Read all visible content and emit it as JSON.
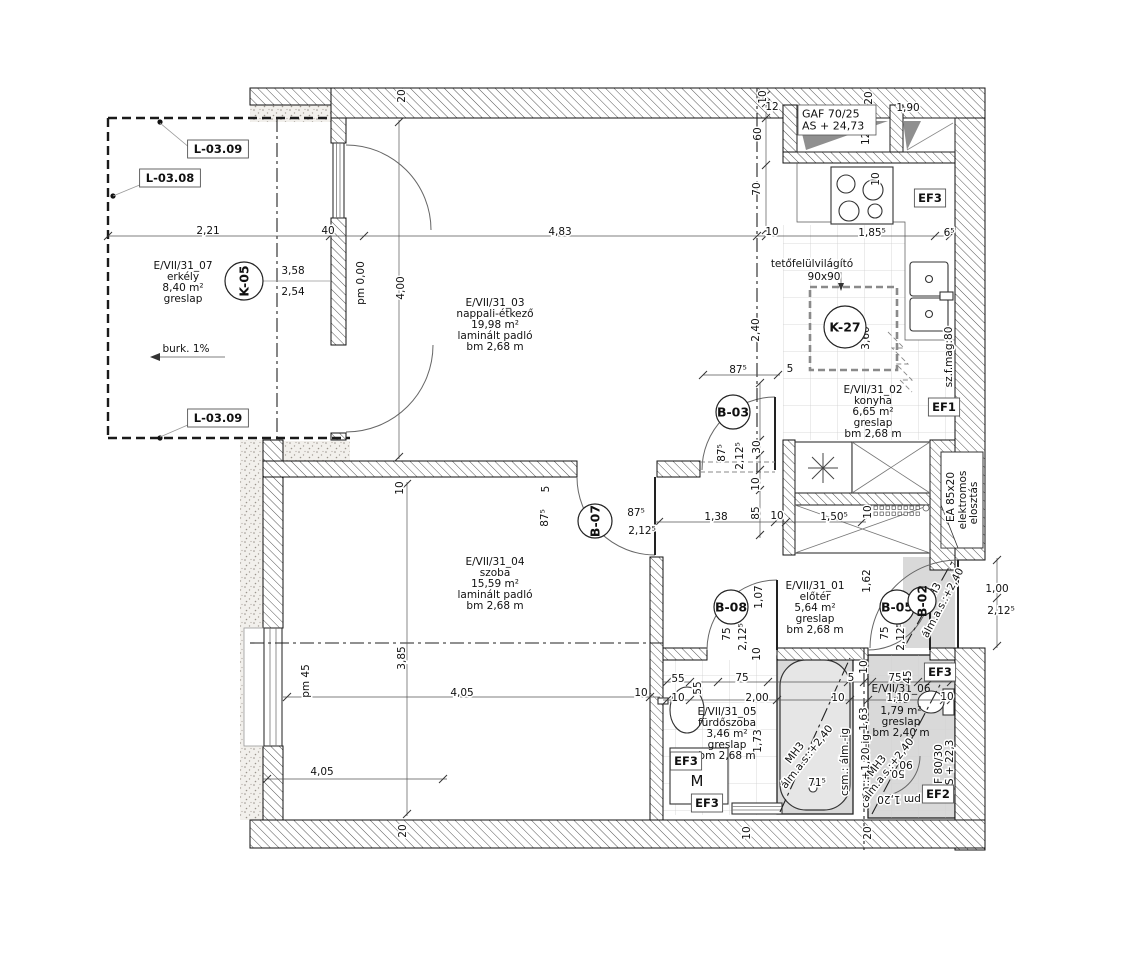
{
  "colors": {
    "wall_line": "#111111",
    "hatch_line": "#555555",
    "lowered_ceiling_zone": "#d9d9d9",
    "tile_grid": "#cccccc",
    "paper": "#ffffff"
  },
  "rooms": [
    {
      "id": "erkely",
      "lines": [
        "E/VII/31_07",
        "erkély",
        "8,40 m²",
        "greslap"
      ],
      "x": 183,
      "y": 266
    },
    {
      "id": "nappali",
      "lines": [
        "E/VII/31_03",
        "nappali-étkező",
        "19,98 m²",
        "laminált padló",
        "bm 2,68 m"
      ],
      "x": 495,
      "y": 303
    },
    {
      "id": "konyha",
      "lines": [
        "E/VII/31_02",
        "konyha",
        "6,65 m²",
        "greslap",
        "bm 2,68 m"
      ],
      "x": 873,
      "y": 390
    },
    {
      "id": "szoba",
      "lines": [
        "E/VII/31_04",
        "szoba",
        "15,59 m²",
        "laminált padló",
        "bm 2,68 m"
      ],
      "x": 495,
      "y": 562
    },
    {
      "id": "eloter",
      "lines": [
        "E/VII/31_01",
        "előtér",
        "5,64 m²",
        "greslap",
        "bm 2,68 m"
      ],
      "x": 815,
      "y": 586
    },
    {
      "id": "furdoszoba",
      "lines": [
        "E/VII/31_05",
        "fürdőszoba",
        "3,46 m²",
        "greslap",
        "bm 2,68 m"
      ],
      "x": 727,
      "y": 712
    },
    {
      "id": "wc",
      "lines": [
        "E/VII/31_06",
        "wc",
        "1,79 m²",
        "greslap",
        "bm 2,40 m"
      ],
      "x": 901,
      "y": 689
    }
  ],
  "tags": [
    {
      "t": "K-05",
      "x": 244,
      "y": 281,
      "r": 19,
      "rot": -90
    },
    {
      "t": "K-27",
      "x": 845,
      "y": 327,
      "r": 21,
      "rot": 0
    },
    {
      "t": "B-03",
      "x": 733,
      "y": 412,
      "r": 17,
      "rot": 0
    },
    {
      "t": "B-07",
      "x": 595,
      "y": 521,
      "r": 17,
      "rot": -90
    },
    {
      "t": "B-08",
      "x": 731,
      "y": 607,
      "r": 17,
      "rot": 0
    },
    {
      "t": "B-05",
      "x": 897,
      "y": 607,
      "r": 17,
      "rot": 0
    },
    {
      "t": "B-02",
      "x": 922,
      "y": 601,
      "r": 14,
      "rot": -90
    }
  ],
  "ref_boxes": [
    {
      "t": "L-03.09",
      "x": 218,
      "y": 149
    },
    {
      "t": "L-03.08",
      "x": 170,
      "y": 178
    },
    {
      "t": "L-03.09",
      "x": 218,
      "y": 418
    },
    {
      "t": "EF3",
      "x": 930,
      "y": 198
    },
    {
      "t": "EF1",
      "x": 944,
      "y": 407
    },
    {
      "t": "EF3",
      "x": 940,
      "y": 672
    },
    {
      "t": "EF3",
      "x": 686,
      "y": 761
    },
    {
      "t": "EF3",
      "x": 707,
      "y": 803
    },
    {
      "t": "EF2",
      "x": 938,
      "y": 794
    }
  ],
  "info_box": {
    "lines": [
      "GAF  70/25",
      "AS + 24,73"
    ],
    "x": 798,
    "y": 105
  },
  "dims": [
    {
      "t": "2,21",
      "x": 208,
      "y": 231
    },
    {
      "t": "40",
      "x": 328,
      "y": 231
    },
    {
      "t": "4,83",
      "x": 560,
      "y": 232
    },
    {
      "t": "10",
      "x": 772,
      "y": 232
    },
    {
      "t": "1,85⁵",
      "x": 872,
      "y": 233
    },
    {
      "t": "6⁵",
      "x": 949,
      "y": 233
    },
    {
      "t": "3,58",
      "x": 293,
      "y": 271
    },
    {
      "t": "2,54",
      "x": 293,
      "y": 292
    },
    {
      "t": "4,00",
      "x": 401,
      "y": 288,
      "r": -90
    },
    {
      "t": "20",
      "x": 402,
      "y": 96,
      "r": -90
    },
    {
      "t": "10",
      "x": 763,
      "y": 97,
      "r": -90
    },
    {
      "t": "12",
      "x": 772,
      "y": 107
    },
    {
      "t": "60",
      "x": 758,
      "y": 134,
      "r": -90
    },
    {
      "t": "70",
      "x": 757,
      "y": 189,
      "r": -90
    },
    {
      "t": "20",
      "x": 869,
      "y": 98,
      "r": -90
    },
    {
      "t": "1,90",
      "x": 908,
      "y": 108
    },
    {
      "t": "10",
      "x": 876,
      "y": 179,
      "r": -90
    },
    {
      "t": "2,40",
      "x": 756,
      "y": 330,
      "r": -90
    },
    {
      "t": "3,60",
      "x": 866,
      "y": 338,
      "r": -90
    },
    {
      "t": "87⁵",
      "x": 738,
      "y": 370
    },
    {
      "t": "5",
      "x": 790,
      "y": 369
    },
    {
      "t": "87⁵",
      "x": 722,
      "y": 453,
      "r": -90
    },
    {
      "t": "2,12⁵",
      "x": 740,
      "y": 456,
      "r": -90
    },
    {
      "t": "30",
      "x": 757,
      "y": 447,
      "r": -90
    },
    {
      "t": "10",
      "x": 756,
      "y": 484,
      "r": -90
    },
    {
      "t": "85",
      "x": 756,
      "y": 513,
      "r": -90
    },
    {
      "t": "10",
      "x": 777,
      "y": 516
    },
    {
      "t": "1,38",
      "x": 716,
      "y": 517
    },
    {
      "t": "1,50⁵",
      "x": 834,
      "y": 517
    },
    {
      "t": "10",
      "x": 868,
      "y": 512,
      "r": -90
    },
    {
      "t": "87⁵",
      "x": 636,
      "y": 513
    },
    {
      "t": "2,12⁵",
      "x": 642,
      "y": 531
    },
    {
      "t": "87⁵",
      "x": 545,
      "y": 518,
      "r": -90
    },
    {
      "t": "5",
      "x": 546,
      "y": 489,
      "r": -90
    },
    {
      "t": "10",
      "x": 400,
      "y": 488,
      "r": -90
    },
    {
      "t": "3,85",
      "x": 402,
      "y": 658,
      "r": -90
    },
    {
      "t": "4,05",
      "x": 462,
      "y": 693
    },
    {
      "t": "10",
      "x": 641,
      "y": 693
    },
    {
      "t": "4,05",
      "x": 322,
      "y": 772
    },
    {
      "t": "20",
      "x": 403,
      "y": 831,
      "r": -90
    },
    {
      "t": "1,07",
      "x": 759,
      "y": 597,
      "r": -90
    },
    {
      "t": "75",
      "x": 727,
      "y": 634,
      "r": -90
    },
    {
      "t": "2,12⁵",
      "x": 743,
      "y": 637,
      "r": -90
    },
    {
      "t": "10",
      "x": 757,
      "y": 654,
      "r": -90
    },
    {
      "t": "1,62",
      "x": 867,
      "y": 581,
      "r": -90
    },
    {
      "t": "75",
      "x": 885,
      "y": 633,
      "r": -90
    },
    {
      "t": "2,12⁵",
      "x": 901,
      "y": 637,
      "r": -90
    },
    {
      "t": "1,00",
      "x": 997,
      "y": 589
    },
    {
      "t": "2,12⁵",
      "x": 1001,
      "y": 611
    },
    {
      "t": "55",
      "x": 678,
      "y": 679
    },
    {
      "t": "55",
      "x": 698,
      "y": 688,
      "r": -90
    },
    {
      "t": "75",
      "x": 742,
      "y": 678
    },
    {
      "t": "5",
      "x": 851,
      "y": 678
    },
    {
      "t": "10",
      "x": 678,
      "y": 698
    },
    {
      "t": "2,00",
      "x": 757,
      "y": 698
    },
    {
      "t": "10",
      "x": 838,
      "y": 698
    },
    {
      "t": "1,73",
      "x": 758,
      "y": 741,
      "r": -90
    },
    {
      "t": "71⁵",
      "x": 817,
      "y": 783
    },
    {
      "t": "1,63",
      "x": 864,
      "y": 719,
      "r": -90
    },
    {
      "t": "10",
      "x": 864,
      "y": 667,
      "r": -90
    },
    {
      "t": "75",
      "x": 895,
      "y": 678
    },
    {
      "t": "45",
      "x": 908,
      "y": 677,
      "r": -90
    },
    {
      "t": "1,10",
      "x": 898,
      "y": 698
    },
    {
      "t": "10",
      "x": 947,
      "y": 697
    },
    {
      "t": "10",
      "x": 747,
      "y": 833,
      "r": -90
    },
    {
      "t": "20",
      "x": 868,
      "y": 833,
      "r": -90
    },
    {
      "t": "50",
      "x": 898,
      "y": 773,
      "r": 180
    },
    {
      "t": "90",
      "x": 906,
      "y": 764,
      "r": 180
    },
    {
      "t": "12  48",
      "x": 866,
      "y": 130,
      "r": -90
    }
  ],
  "notes": [
    {
      "t": "tetőfelülvilágító",
      "x": 812,
      "y": 264
    },
    {
      "t": "90x90",
      "x": 824,
      "y": 277
    },
    {
      "t": "burk. 1%",
      "x": 186,
      "y": 349
    },
    {
      "t": "pm 0,00",
      "x": 361,
      "y": 283,
      "r": -90
    },
    {
      "t": "pm 45",
      "x": 306,
      "y": 681,
      "r": -90
    },
    {
      "t": "sz.f.mag:80",
      "x": 949,
      "y": 357,
      "r": -90
    },
    {
      "t": "EA 85x20",
      "x": 951,
      "y": 497,
      "r": -90
    },
    {
      "t": "elektromos",
      "x": 963,
      "y": 500,
      "r": -90
    },
    {
      "t": "elosztás",
      "x": 974,
      "y": 503,
      "r": -90
    },
    {
      "t": "csm.: álm.-ig",
      "x": 845,
      "y": 762,
      "r": -90
    },
    {
      "t": "csm.:+1,20-ig",
      "x": 866,
      "y": 771,
      "r": -90
    },
    {
      "t": "MH3",
      "x": 795,
      "y": 753,
      "r": -52
    },
    {
      "t": "álm.a.s.:+2,40",
      "x": 807,
      "y": 757,
      "r": -52
    },
    {
      "t": "MH3",
      "x": 877,
      "y": 766,
      "r": -52
    },
    {
      "t": "álm.a.s.:+2,40",
      "x": 888,
      "y": 770,
      "r": -52
    },
    {
      "t": "MH3",
      "x": 933,
      "y": 594,
      "r": -62
    },
    {
      "t": "álm.a.s.:+2,40",
      "x": 943,
      "y": 603,
      "r": -62
    },
    {
      "t": "M",
      "x": 697,
      "y": 781,
      "s": 15
    },
    {
      "t": "F 80/30",
      "x": 939,
      "y": 764,
      "r": -90
    },
    {
      "t": "AS + 22,3",
      "x": 950,
      "y": 766,
      "r": -90
    },
    {
      "t": "pm 1,20",
      "x": 899,
      "y": 799,
      "r": 180
    }
  ]
}
